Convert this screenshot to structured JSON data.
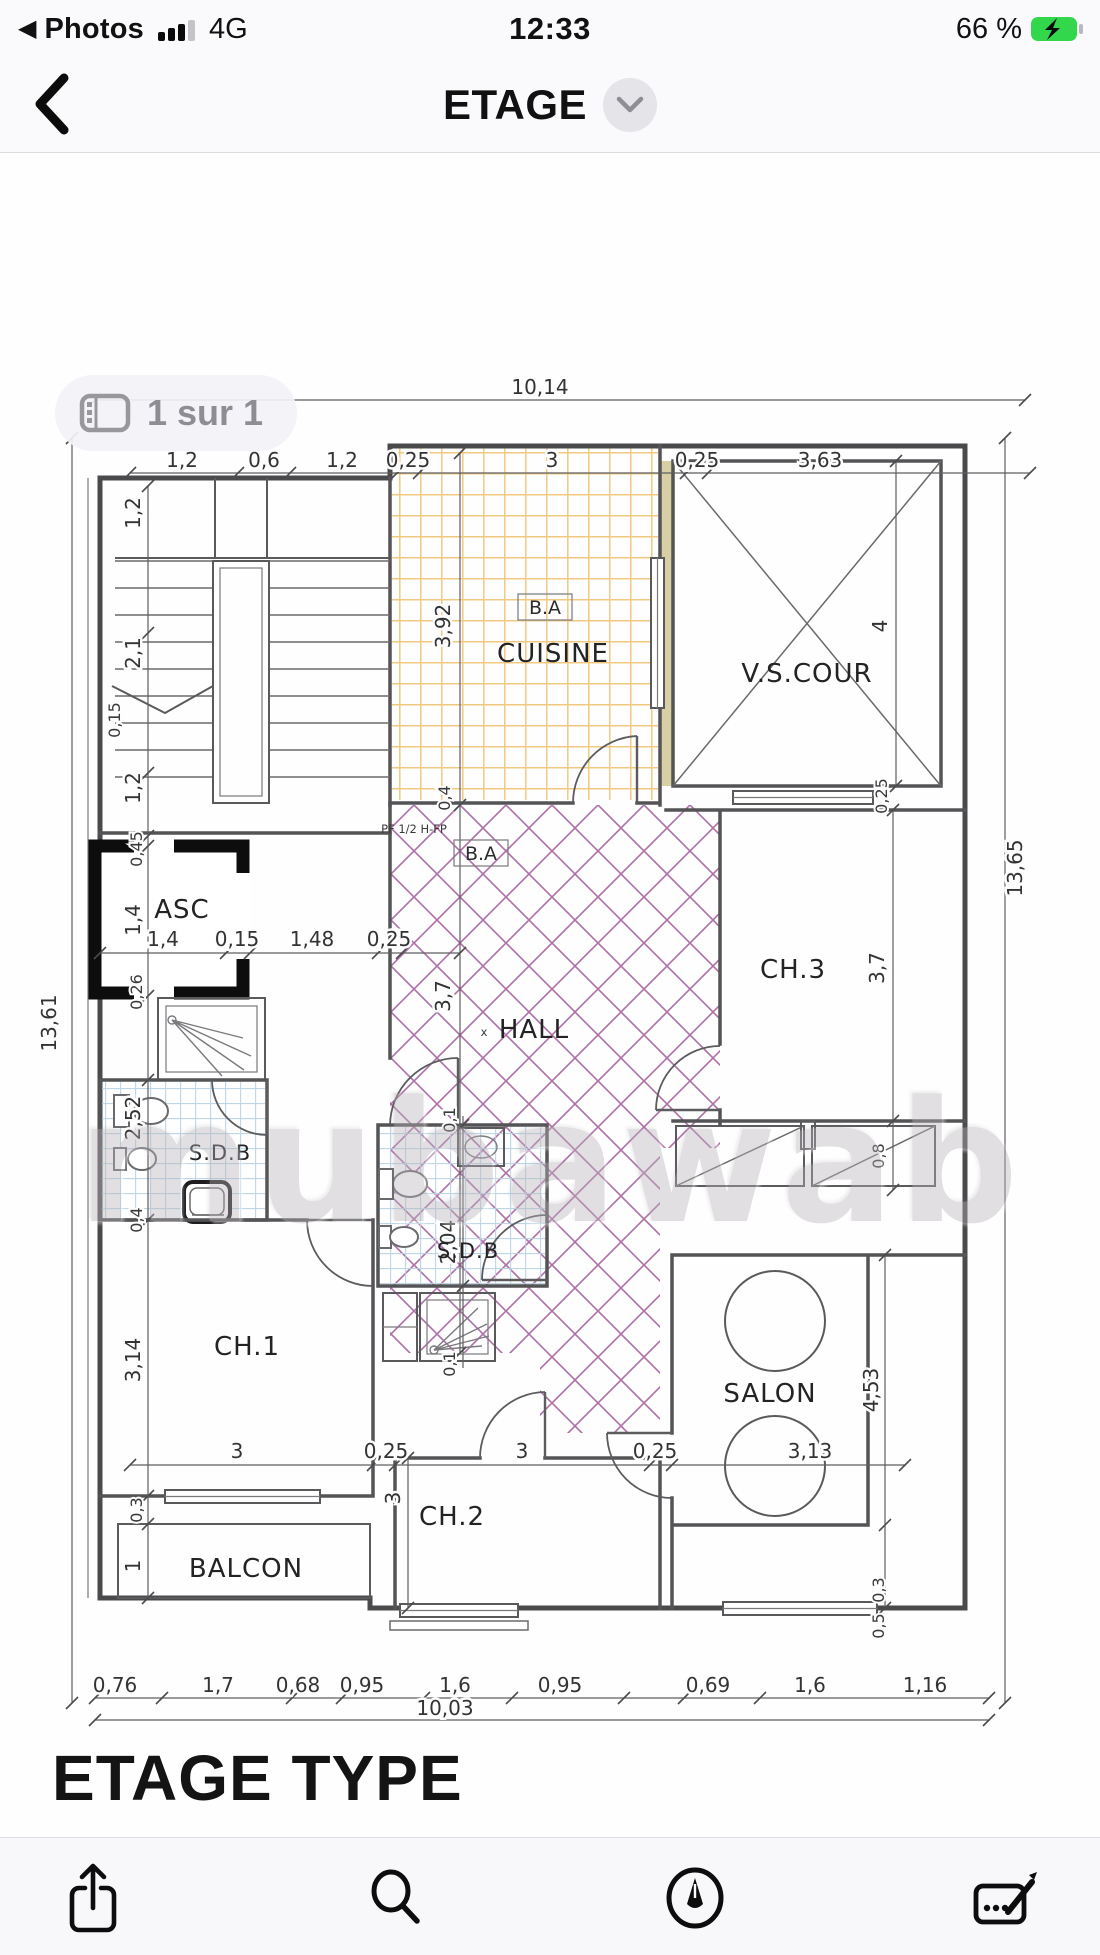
{
  "status_bar": {
    "back_glyph": "◀",
    "back_app_label": "Photos",
    "network": "4G",
    "time": "12:33",
    "battery_percent": "66 %"
  },
  "nav_bar": {
    "title": "ETAGE"
  },
  "viewer": {
    "page_badge": "1 sur 1"
  },
  "plan": {
    "title": "ETAGE TYPE",
    "watermark": "mubawab",
    "rooms": {
      "cuisine": "CUISINE",
      "vs_cour": "V.S.COUR",
      "asc": "ASC",
      "hall": "HALL",
      "hall_marker": "x",
      "ch3": "CH.3",
      "sdb_left": "S.D.B",
      "sdb_center": "S.D.B",
      "ch1": "CH.1",
      "salon": "SALON",
      "ch2": "CH.2",
      "balcon": "BALCON"
    },
    "notes": {
      "ba_cuisine": "B.A",
      "ba_hall": "B.A",
      "pf": "PF 1/2 H-FP"
    },
    "dims": {
      "total_top": "10,14",
      "row_top": [
        "1,2",
        "0,6",
        "1,2",
        "0,25",
        "3",
        "0,25",
        "3,63"
      ],
      "left_total": "13,61",
      "right_total": "13,65",
      "left_col": [
        "1,2",
        "2,1",
        "1,2",
        "0,45",
        "1,4",
        "0,26",
        "2,52",
        "0,4",
        "3,14",
        "0,3",
        "1"
      ],
      "left_col_extra": "0,15",
      "asc_row": [
        "1,4",
        "0,15",
        "1,48",
        "0,25"
      ],
      "cuisine_h": "3,92",
      "cuisine_door": "0,4",
      "vscour_h": "4",
      "vscour_bottom": "0,25",
      "hall_h": "3,7",
      "ch3_h": "3,7",
      "ch3_bottom": "0,8",
      "sdb2_top": "0,1",
      "sdb2_h": "2,04",
      "sdb2_bottom": "0,1",
      "row_mid": [
        "3",
        "0,25",
        "3",
        "0,25",
        "3,13"
      ],
      "salon_h": "4,53",
      "ch2_h": "3",
      "win_right": [
        "0,3",
        "0,5"
      ],
      "row_bottom": [
        "0,76",
        "1,7",
        "0,68",
        "0,95",
        "1,6",
        "0,95",
        "0,69",
        "1,6",
        "1,16"
      ],
      "total_bottom": "10,03"
    }
  },
  "toolbar": {
    "icons": [
      "share",
      "search",
      "markup",
      "signature"
    ]
  },
  "colors": {
    "battery_green": "#32d74b",
    "hatch_purple": "#a2589a",
    "tile_orange": "#eec06b",
    "tile_blue": "#b7d2e4"
  }
}
